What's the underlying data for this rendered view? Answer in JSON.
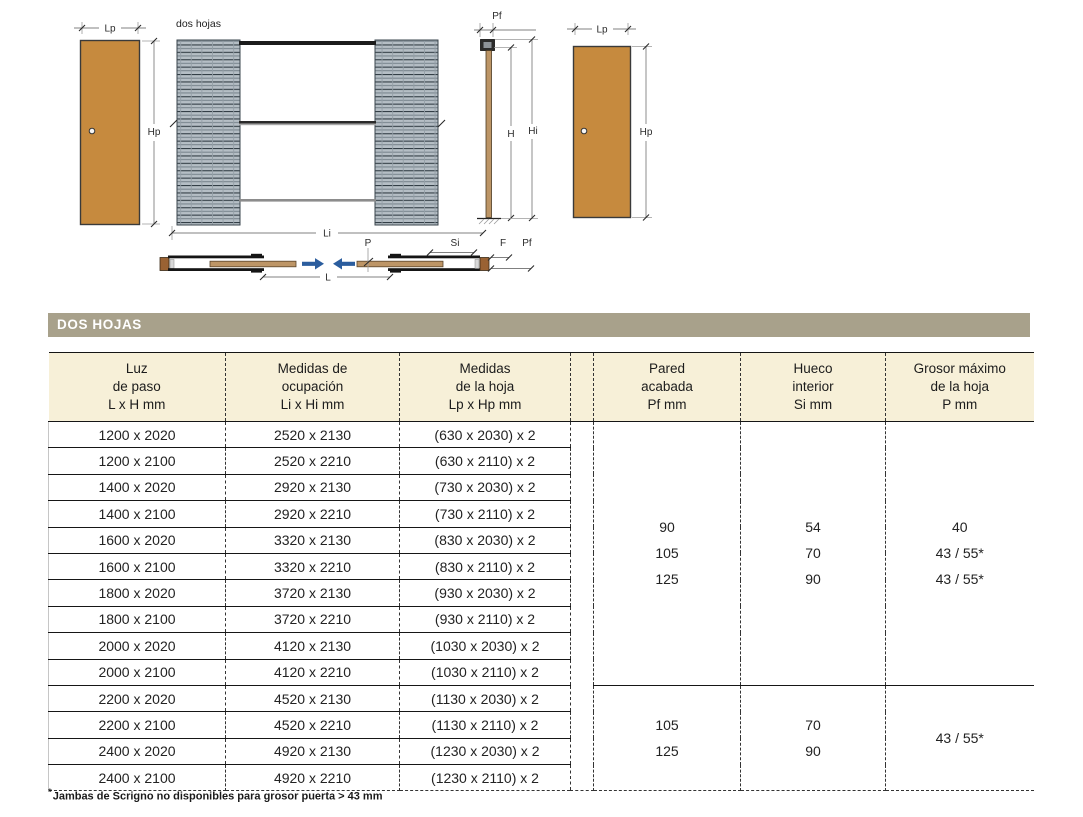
{
  "section_title": "DOS HOJAS",
  "diagram": {
    "title": "dos hojas",
    "labels": {
      "lp": "Lp",
      "hp": "Hp",
      "li": "Li",
      "l": "L",
      "p": "P",
      "si": "Si",
      "f": "F",
      "pf": "Pf",
      "h": "H",
      "hi": "Hi"
    },
    "colors": {
      "door_panel": "#c68a3e",
      "plan_door": "#bd9566",
      "pocket_hatch_base": "#b5bec5",
      "arrow_blue": "#2b5d9e"
    }
  },
  "table": {
    "headers": [
      "Luz\nde paso\nL x H mm",
      "Medidas de\nocupación\nLi x Hi mm",
      "Medidas\nde la hoja\nLp x Hp mm",
      "Pared\nacabada\nPf mm",
      "Hueco\ninterior\nSi mm",
      "Grosor máximo\nde la hoja\nP mm"
    ],
    "rows": [
      [
        "1200 x 2020",
        "2520 x 2130",
        "(630 x 2030) x 2"
      ],
      [
        "1200 x 2100",
        "2520 x 2210",
        "(630 x 2110) x 2"
      ],
      [
        "1400 x 2020",
        "2920 x 2130",
        "(730 x 2030) x 2"
      ],
      [
        "1400 x 2100",
        "2920 x 2210",
        "(730 x 2110) x 2"
      ],
      [
        "1600 x 2020",
        "3320 x 2130",
        "(830 x 2030) x 2"
      ],
      [
        "1600 x 2100",
        "3320 x 2210",
        "(830 x 2110) x 2"
      ],
      [
        "1800 x 2020",
        "3720 x 2130",
        "(930 x 2030) x 2"
      ],
      [
        "1800 x 2100",
        "3720 x 2210",
        "(930 x 2110) x 2"
      ],
      [
        "2000 x 2020",
        "4120 x 2130",
        "(1030 x 2030) x 2"
      ],
      [
        "2000 x 2100",
        "4120 x 2210",
        "(1030 x 2110) x 2"
      ],
      [
        "2200 x 2020",
        "4520 x 2130",
        "(1130 x 2030) x 2"
      ],
      [
        "2200 x 2100",
        "4520 x 2210",
        "(1130 x 2110) x 2"
      ],
      [
        "2400 x 2020",
        "4920 x 2130",
        "(1230 x 2030) x 2"
      ],
      [
        "2400 x 2100",
        "4920 x 2210",
        "(1230 x 2110) x 2"
      ]
    ],
    "group1": {
      "pf": "90\n105\n125",
      "si": "54\n70\n90",
      "p": "40\n43 / 55*\n43 / 55*"
    },
    "group2": {
      "pf": "105\n125",
      "si": "70\n90",
      "p": "43 / 55*"
    }
  },
  "footnote": {
    "marker": "*",
    "text": "Jambas de Scrigno no disponibles para grosor puerta > 43 mm"
  },
  "ui_colors": {
    "section_bar": "#a8a18b",
    "header_bg": "#f7f0d8",
    "line_dark": "#161616"
  }
}
